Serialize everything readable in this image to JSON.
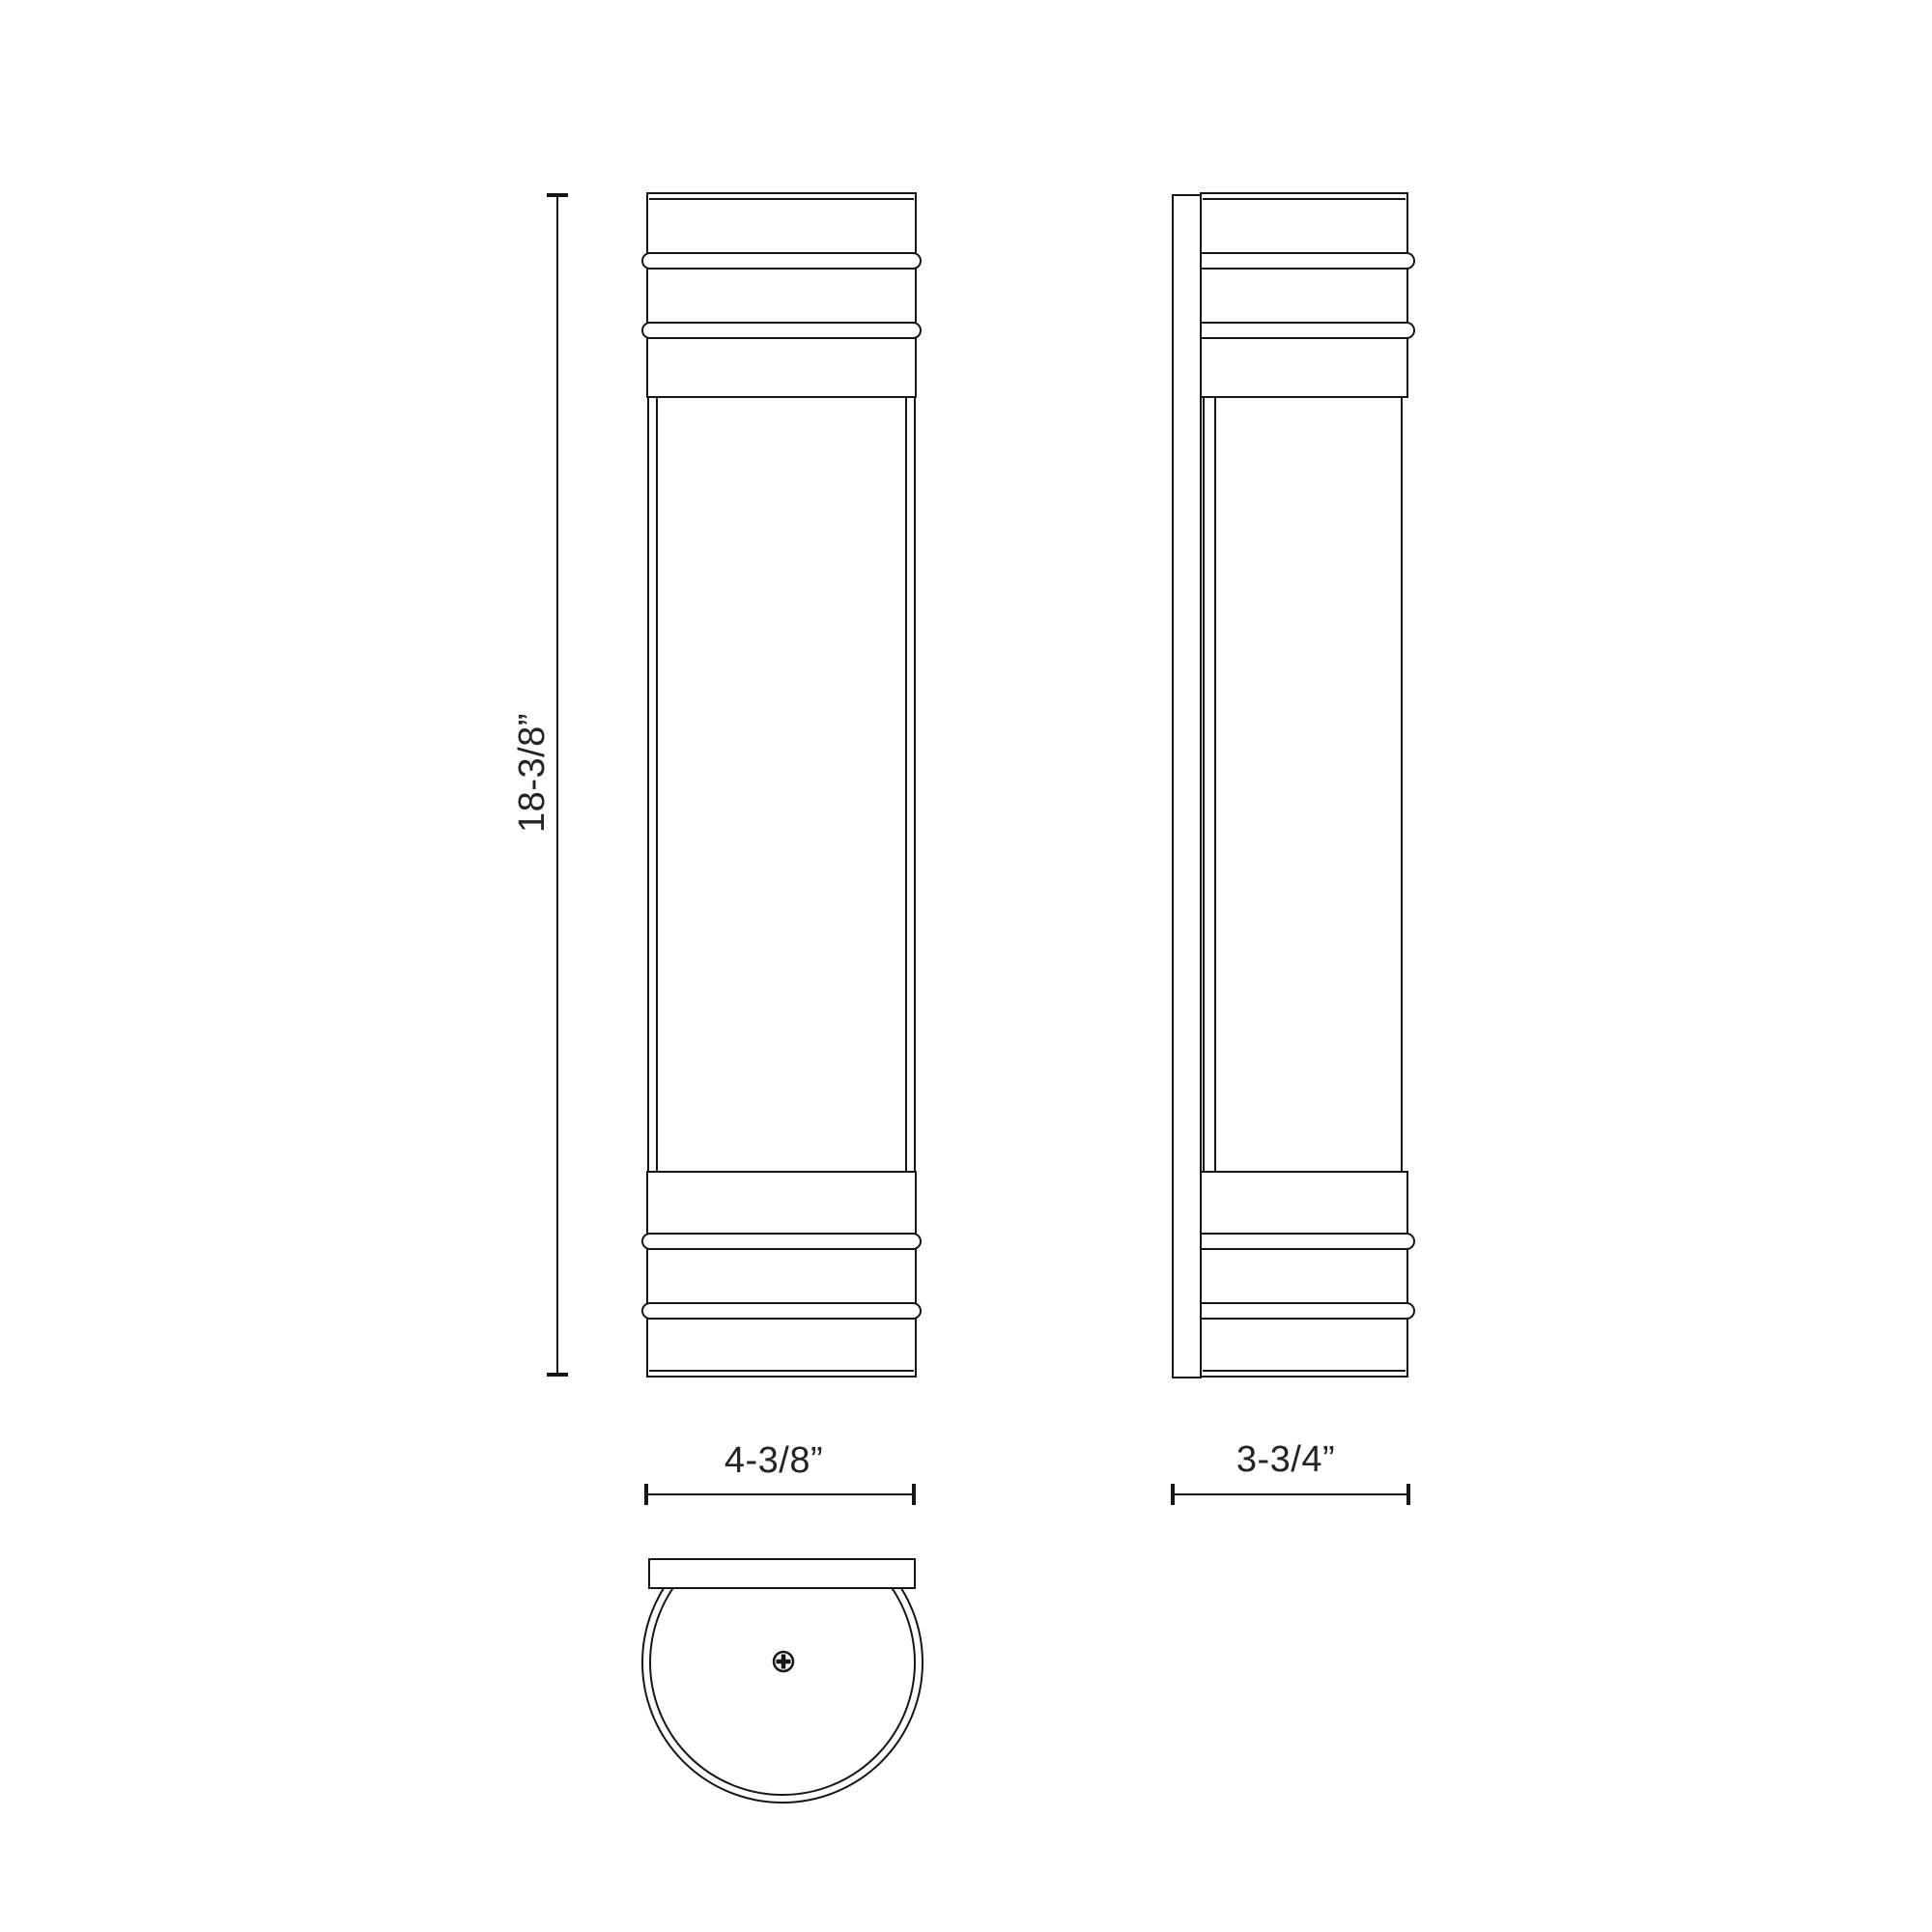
{
  "colors": {
    "line": "#161616",
    "text": "#242424",
    "background": "#ffffff"
  },
  "dimension_labels": {
    "height": "18-3/8”",
    "front_width": "4-3/8”",
    "side_depth": "3-3/4”"
  },
  "icons": {
    "screw": "phillips-screw-head"
  }
}
